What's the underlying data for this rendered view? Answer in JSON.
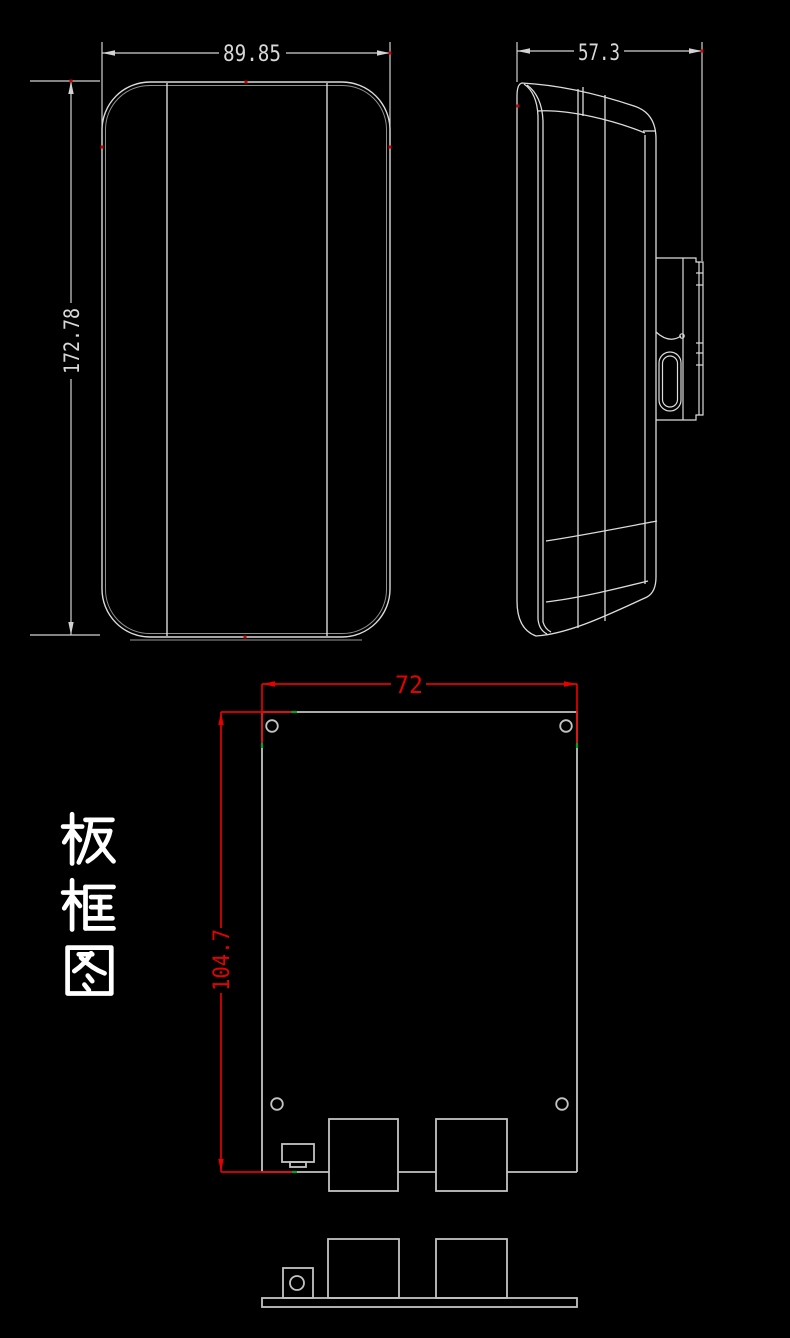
{
  "page": {
    "background": "#000000",
    "kind": "CAD mechanical drawing screenshot"
  },
  "labels": {
    "board_outline_title": "板框图"
  },
  "dimensions": {
    "enclosure_width": "89.85",
    "enclosure_height": "172.78",
    "enclosure_depth": "57.3",
    "board_width": "72",
    "board_height": "104.7"
  },
  "colors": {
    "background": "#000000",
    "outline_white": "#dcdcdc",
    "pcb_gray": "#c3c3c3",
    "dimension_red": "#e60000",
    "snap_marker_green": "#00a321",
    "endpoint_marker_red": "#cc0000",
    "title_white": "#ffffff"
  },
  "views": [
    {
      "id": "front-view"
    },
    {
      "id": "side-view"
    },
    {
      "id": "board-outline-view"
    },
    {
      "id": "board-side-view"
    }
  ]
}
